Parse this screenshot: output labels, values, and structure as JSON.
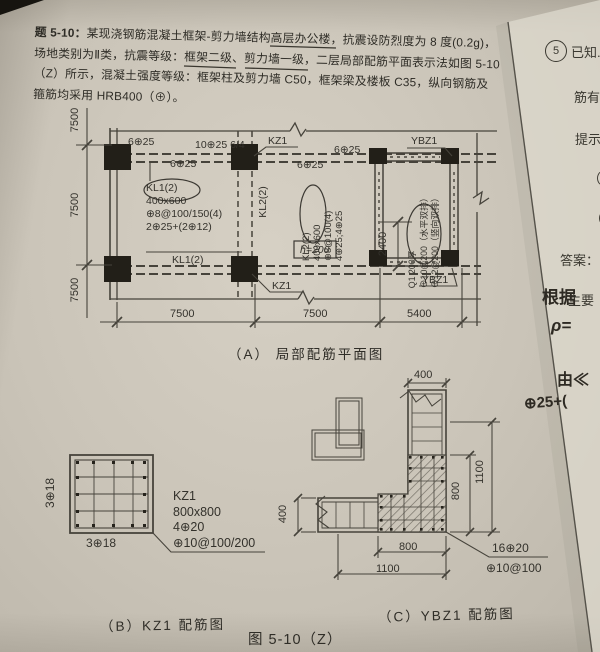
{
  "problem": {
    "tag": "题 5-10：",
    "line1": "某现浇钢筋混凝土框架-剪力墙结构高层办公楼，抗震设防烈度为 8 度(0.2g)，",
    "line2": "场地类别为Ⅱ类，抗震等级：框架二级、剪力墙一级，二层局部配筋平面表示法如图 5-10",
    "line3": "（Z）所示，混凝土强度等级：框架柱及剪力墙 C50，框架梁及楼板 C35，纵向钢筋及",
    "line4": "箍筋均采用 HRB400（⊕）。"
  },
  "plan": {
    "caption": "（A） 局部配筋平面图",
    "top_bars_left": "6⊕25",
    "support_bars": "10⊕25 6/4",
    "bottom_bars_left": "6⊕25",
    "top_bars_right": "6⊕25",
    "bottom_bars_right": "6⊕25",
    "kz1": "KZ1",
    "ybz1": "YBZ1",
    "kl1_span": "KL1(2)",
    "kl2_span": "KL2(2)",
    "kl1_ann": {
      "name": "KL1(2)",
      "size": "400x600",
      "stirrup": "⊕8@100/150(4)",
      "bars": "2⊕25+(2⊕12)"
    },
    "kl2_ann": {
      "name": "KL2(2)",
      "size": "400x600",
      "stirrup": "⊕8@100(4)",
      "bars": "4⊕25;4⊕25"
    },
    "wall_ann": {
      "name": "Q1 200厚",
      "horiz": "⊕10@200（水平双排）",
      "vert": "⊕12@200（竖向双排）"
    },
    "slab_thickness": "h=200",
    "dim_left": "7500",
    "dim_bay1": "7500",
    "dim_bay2": "7500",
    "dim_bay3": "5400",
    "dim_opening": "2400"
  },
  "kz1_detail": {
    "caption": "（B）KZ1 配筋图",
    "side_bars": "3⊕18",
    "bottom_bars": "3⊕18",
    "name": "KZ1",
    "size": "800x800",
    "corner_bars": "4⊕20",
    "stirrup": "⊕10@100/200"
  },
  "ybz1_detail": {
    "caption": "（C）YBZ1 配筋图",
    "dim_top": "400",
    "dim_right_outer": "1100",
    "dim_right_inner": "800",
    "dim_left": "400",
    "dim_bottom_inner": "800",
    "dim_bottom_outer": "1100",
    "bars": "16⊕20",
    "stirrup": "⊕10@100"
  },
  "figure_caption": "图 5-10（Z）",
  "margin": {
    "num": "5",
    "t1": "已知.",
    "t2": "筋有",
    "t3": "提示",
    "t4": "（",
    "t5": "（",
    "t6": "答案：",
    "t7": "主要",
    "h1": "根据",
    "h2": "ρ=",
    "h3": "由≪",
    "h4": "⊕25+("
  }
}
